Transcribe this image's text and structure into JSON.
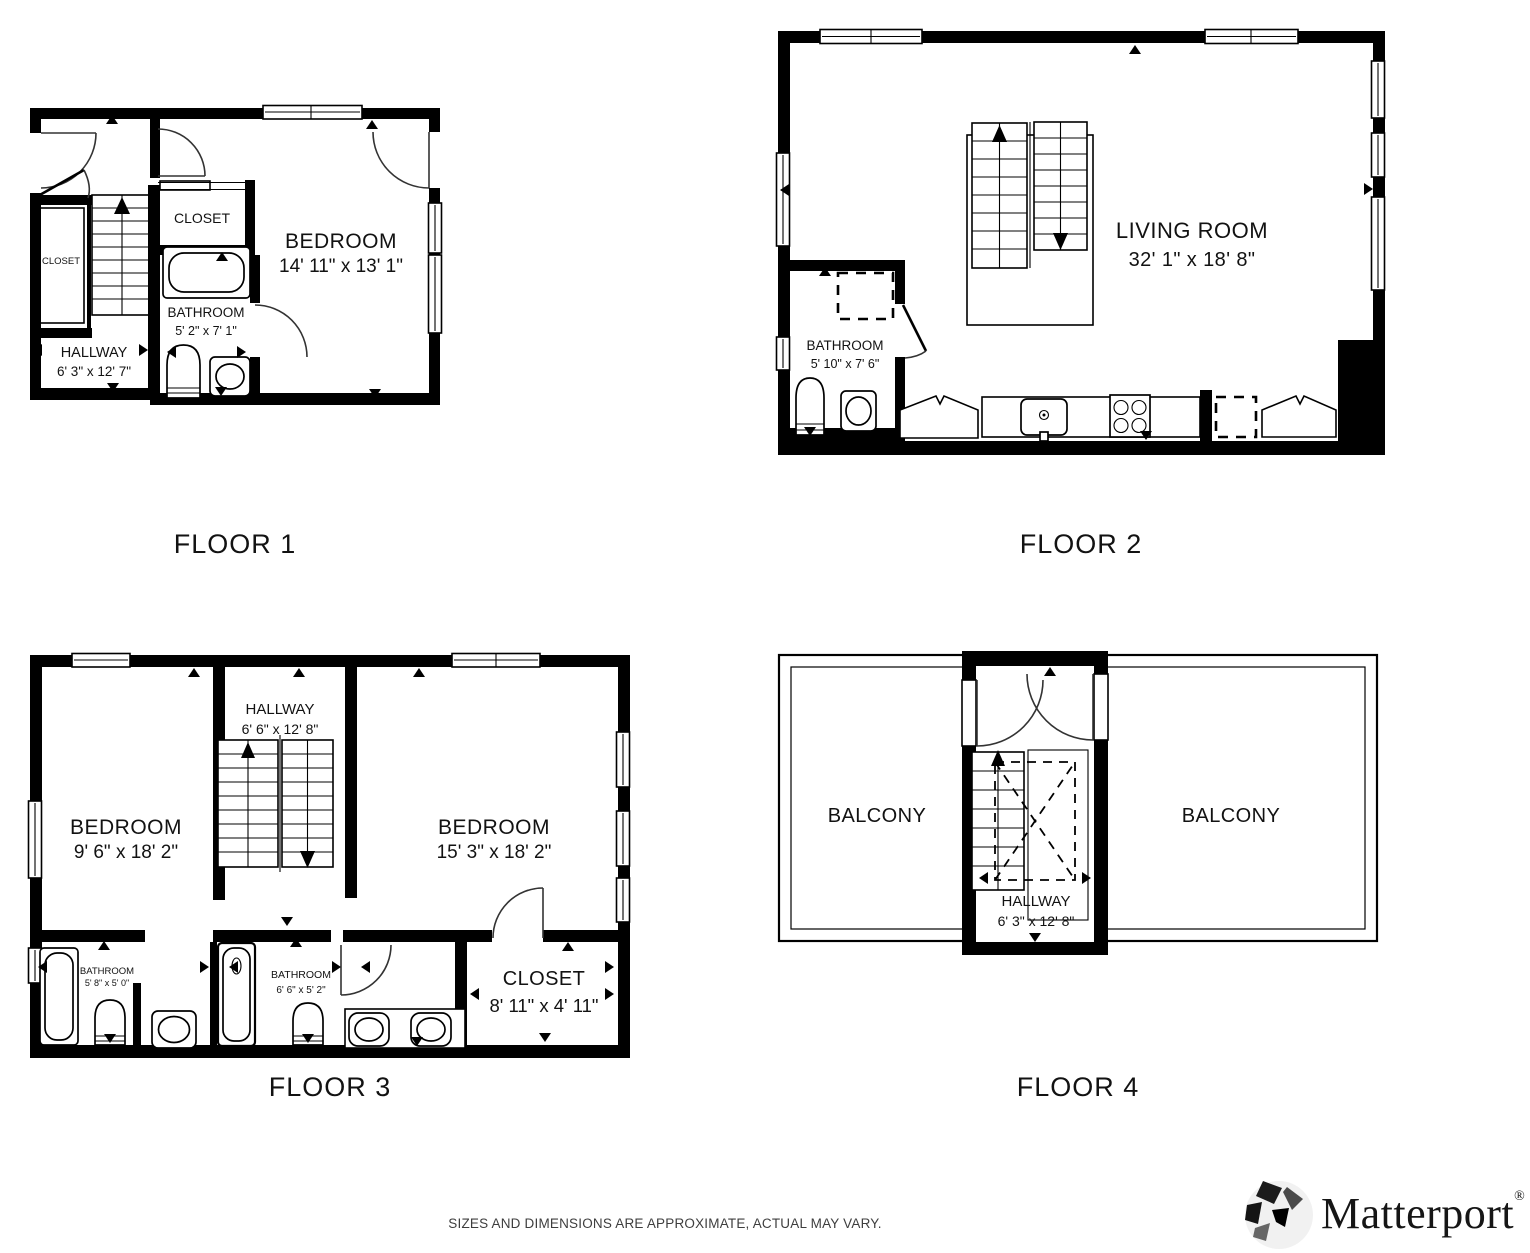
{
  "floor1": {
    "label": "FLOOR 1",
    "bedroom": {
      "name": "BEDROOM",
      "dims": "14' 11\" x 13' 1\""
    },
    "bathroom": {
      "name": "BATHROOM",
      "dims": "5' 2\" x 7' 1\""
    },
    "hallway": {
      "name": "HALLWAY",
      "dims": "6' 3\" x 12' 7\""
    },
    "closet_top": {
      "name": "CLOSET"
    },
    "closet_side": {
      "name": "CLOSET"
    }
  },
  "floor2": {
    "label": "FLOOR 2",
    "living_room": {
      "name": "LIVING ROOM",
      "dims": "32' 1\" x 18' 8\""
    },
    "bathroom": {
      "name": "BATHROOM",
      "dims": "5' 10\" x 7' 6\""
    }
  },
  "floor3": {
    "label": "FLOOR 3",
    "bedroom_left": {
      "name": "BEDROOM",
      "dims": "9' 6\" x 18' 2\""
    },
    "bedroom_right": {
      "name": "BEDROOM",
      "dims": "15' 3\" x 18' 2\""
    },
    "hallway": {
      "name": "HALLWAY",
      "dims": "6' 6\" x 12' 8\""
    },
    "bathroom_left": {
      "name": "BATHROOM",
      "dims": "5' 8\" x 5' 0\""
    },
    "bathroom_mid": {
      "name": "BATHROOM",
      "dims": "6' 6\" x 5' 2\""
    },
    "closet": {
      "name": "CLOSET",
      "dims": "8' 11\" x 4' 11\""
    }
  },
  "floor4": {
    "label": "FLOOR 4",
    "balcony_left": {
      "name": "BALCONY"
    },
    "balcony_right": {
      "name": "BALCONY"
    },
    "hallway": {
      "name": "HALLWAY",
      "dims": "6' 3\" x 12' 8\""
    }
  },
  "footer": {
    "disclaimer": "SIZES AND DIMENSIONS ARE APPROXIMATE, ACTUAL MAY VARY."
  },
  "brand": {
    "name": "Matterport",
    "registered": "®"
  }
}
